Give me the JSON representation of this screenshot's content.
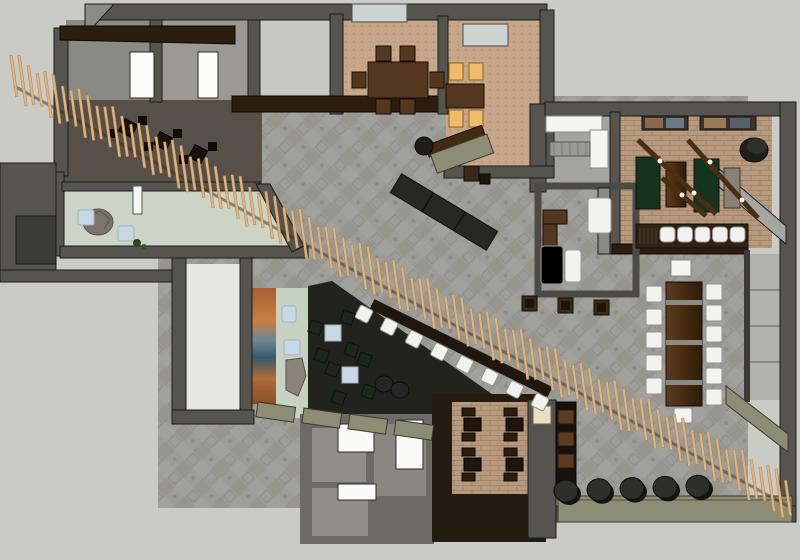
{
  "palette": {
    "bg": "#cbcbc6",
    "wall": "#55544e",
    "wall_light": "#8b8b85",
    "wall_dark": "#34332f",
    "outline": "#1b1b19",
    "tile": "#9c9c98",
    "tile_line": "#8e8e8a",
    "carpet": "#c6a588",
    "brick": "#b79a7d",
    "brick_line": "#a3866a",
    "mint": "#ccd5c5",
    "walnut": "#53371f",
    "walnut_dark": "#2c1d0e",
    "darkwood_floor": "#241b11",
    "booth_green": "#16331d",
    "chair_green": "#1b281b",
    "amber": "#f0bc6a",
    "white_chair": "#f2f2ee",
    "blue_table": "#c8d8e4",
    "slat": "#e2b47b",
    "slat_edge": "#a87c4a",
    "olive": "#8d8d75",
    "black_seat": "#2e2e2b",
    "dark_bench": "#272723",
    "mural_orange": "#b66a3a",
    "mural_blue": "#446074",
    "rock": "#7b746c",
    "glass": "#ccd4d2",
    "corridor_white": "#e6e6e1",
    "lounge_dark": "#23231e",
    "kitchen_dark": "#47413a"
  },
  "scene": {
    "slat_screen": {
      "count": 92
    },
    "private_dining_left": {
      "chairs": 6
    },
    "private_dining_right": {
      "chairs": 4,
      "lit_seats": true
    },
    "booth_room": {
      "booths": 3,
      "pendant_beams": 3,
      "pictures": 2
    },
    "booth_bar": {
      "stools": 5
    },
    "long_table": {
      "chairs_left": 5,
      "chairs_right": 6,
      "chairs_end": 1,
      "metal_bands": 3
    },
    "diagonal_bar": {
      "stools": 8
    },
    "lounge": {
      "clusters": 2,
      "chairs_per_cluster": 4,
      "round_poufs": 2
    },
    "pouf_row": {
      "count": 5
    },
    "bottom_dining": {
      "tables": 4
    },
    "entry": {
      "benches": 2,
      "rock_features": 2
    },
    "kitchen_tables": {
      "count": 3
    },
    "office": {
      "guest_stools": 3
    },
    "shelf_unit": {
      "boxes": 3
    },
    "khaki_benches": {
      "count": 4
    }
  }
}
